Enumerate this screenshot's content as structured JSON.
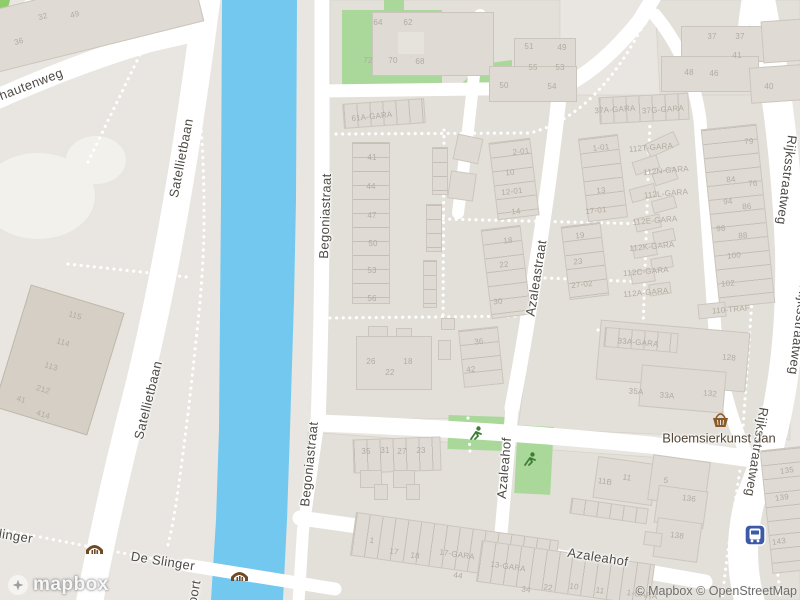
{
  "map": {
    "street_labels": [
      {
        "id": "hautenweg",
        "text": "hautenweg"
      },
      {
        "id": "satellietbaan-upper",
        "text": "Satellietbaan"
      },
      {
        "id": "satellietbaan-lower",
        "text": "Satellietbaan"
      },
      {
        "id": "begoniastraat-upper",
        "text": "Begoniastraat"
      },
      {
        "id": "begoniastraat-lower",
        "text": "Begoniastraat"
      },
      {
        "id": "azaleastraat",
        "text": "Azaleastraat"
      },
      {
        "id": "azaleahof-vertical",
        "text": "Azaleahof"
      },
      {
        "id": "azaleahof-bottom",
        "text": "Azaleahof"
      },
      {
        "id": "rijksstraatweg-upper",
        "text": "Rijksstraatweg"
      },
      {
        "id": "rijksstraatweg-middle",
        "text": "Rijksstraatweg"
      },
      {
        "id": "rijksstraatweg-lower",
        "text": "Rijksstraatweg"
      },
      {
        "id": "de-slinger",
        "text": "De Slinger"
      },
      {
        "id": "slinger-partial",
        "text": "linger"
      },
      {
        "id": "oort-partial",
        "text": "oort"
      }
    ],
    "poi": {
      "name": "Bloemsierkunst Jan",
      "icon": "basket-icon"
    },
    "icons": [
      "bridge-icon",
      "bridge-icon",
      "playground-icon",
      "playground-icon",
      "bus-stop-icon",
      "basket-icon"
    ],
    "colors": {
      "water": "#73c8ef",
      "green": "#a9d89a",
      "hedge": "#8fcd6a",
      "road": "#ffffff",
      "land": "#e9e6e1",
      "building": "#dfdbd4",
      "bus_blue": "#3d5aa8",
      "bridge_brown": "#6e4a26",
      "play_green": "#3f7d35",
      "basket_brown": "#8a5a2b"
    },
    "building_labels": [
      {
        "t": "32",
        "x": 43,
        "y": 17,
        "r": -15
      },
      {
        "t": "49",
        "x": 75,
        "y": 15,
        "r": -15
      },
      {
        "t": "36",
        "x": 19,
        "y": 42,
        "r": -15
      },
      {
        "t": "64",
        "x": 378,
        "y": 23,
        "r": 0
      },
      {
        "t": "62",
        "x": 408,
        "y": 23,
        "r": 0
      },
      {
        "t": "72",
        "x": 368,
        "y": 61,
        "r": 0
      },
      {
        "t": "70",
        "x": 393,
        "y": 61,
        "r": 0
      },
      {
        "t": "68",
        "x": 420,
        "y": 62,
        "r": 0
      },
      {
        "t": "51",
        "x": 529,
        "y": 47,
        "r": 0
      },
      {
        "t": "49",
        "x": 562,
        "y": 48,
        "r": 0
      },
      {
        "t": "55",
        "x": 533,
        "y": 68,
        "r": 0
      },
      {
        "t": "53",
        "x": 560,
        "y": 68,
        "r": 0
      },
      {
        "t": "50",
        "x": 504,
        "y": 86,
        "r": 0
      },
      {
        "t": "54",
        "x": 552,
        "y": 87,
        "r": 0
      },
      {
        "t": "37",
        "x": 712,
        "y": 37,
        "r": 0
      },
      {
        "t": "37",
        "x": 740,
        "y": 37,
        "r": 0
      },
      {
        "t": "41",
        "x": 737,
        "y": 56,
        "r": 0
      },
      {
        "t": "48",
        "x": 689,
        "y": 73,
        "r": 0
      },
      {
        "t": "46",
        "x": 714,
        "y": 74,
        "r": 0
      },
      {
        "t": "40",
        "x": 769,
        "y": 87,
        "r": 0
      },
      {
        "t": "61A-GARA",
        "x": 372,
        "y": 117,
        "r": -6
      },
      {
        "t": "37A-GARA",
        "x": 615,
        "y": 110,
        "r": -4
      },
      {
        "t": "37G-GARA",
        "x": 663,
        "y": 110,
        "r": -4
      },
      {
        "t": "41",
        "x": 372,
        "y": 158,
        "r": 0
      },
      {
        "t": "44",
        "x": 371,
        "y": 187,
        "r": 0
      },
      {
        "t": "47",
        "x": 372,
        "y": 216,
        "r": 0
      },
      {
        "t": "50",
        "x": 373,
        "y": 244,
        "r": 0
      },
      {
        "t": "53",
        "x": 372,
        "y": 271,
        "r": 0
      },
      {
        "t": "56",
        "x": 372,
        "y": 299,
        "r": 0
      },
      {
        "t": "2-01",
        "x": 521,
        "y": 152,
        "r": -6
      },
      {
        "t": "10",
        "x": 510,
        "y": 173,
        "r": -6
      },
      {
        "t": "12-01",
        "x": 512,
        "y": 192,
        "r": -6
      },
      {
        "t": "14",
        "x": 516,
        "y": 212,
        "r": -6
      },
      {
        "t": "18",
        "x": 508,
        "y": 241,
        "r": -6
      },
      {
        "t": "22",
        "x": 504,
        "y": 265,
        "r": -6
      },
      {
        "t": "30",
        "x": 498,
        "y": 302,
        "r": -6
      },
      {
        "t": "1-01",
        "x": 601,
        "y": 148,
        "r": -6
      },
      {
        "t": "13",
        "x": 601,
        "y": 191,
        "r": -6
      },
      {
        "t": "17-01",
        "x": 596,
        "y": 211,
        "r": -6
      },
      {
        "t": "19",
        "x": 580,
        "y": 236,
        "r": -6
      },
      {
        "t": "23",
        "x": 578,
        "y": 262,
        "r": -6
      },
      {
        "t": "27-02",
        "x": 582,
        "y": 285,
        "r": -6
      },
      {
        "t": "112T-GARA",
        "x": 651,
        "y": 148,
        "r": -5
      },
      {
        "t": "112N-GARA",
        "x": 666,
        "y": 171,
        "r": -5
      },
      {
        "t": "112L-GARA",
        "x": 666,
        "y": 194,
        "r": -5
      },
      {
        "t": "112E-GARA",
        "x": 655,
        "y": 221,
        "r": -5
      },
      {
        "t": "112K-GARA",
        "x": 652,
        "y": 247,
        "r": -5
      },
      {
        "t": "112C-GARA",
        "x": 646,
        "y": 272,
        "r": -5
      },
      {
        "t": "112A-GARA",
        "x": 646,
        "y": 293,
        "r": -5
      },
      {
        "t": "110-TRAF",
        "x": 731,
        "y": 310,
        "r": -5
      },
      {
        "t": "79",
        "x": 749,
        "y": 142,
        "r": -5
      },
      {
        "t": "84",
        "x": 731,
        "y": 180,
        "r": -5
      },
      {
        "t": "76",
        "x": 753,
        "y": 184,
        "r": -5
      },
      {
        "t": "94",
        "x": 728,
        "y": 202,
        "r": -5
      },
      {
        "t": "86",
        "x": 747,
        "y": 207,
        "r": -5
      },
      {
        "t": "98",
        "x": 721,
        "y": 229,
        "r": -5
      },
      {
        "t": "88",
        "x": 743,
        "y": 236,
        "r": -5
      },
      {
        "t": "100",
        "x": 734,
        "y": 256,
        "r": -5
      },
      {
        "t": "102",
        "x": 728,
        "y": 284,
        "r": -5
      },
      {
        "t": "33A-GARA",
        "x": 638,
        "y": 343,
        "r": 5
      },
      {
        "t": "128",
        "x": 729,
        "y": 358,
        "r": 5
      },
      {
        "t": "35A",
        "x": 636,
        "y": 392,
        "r": 5
      },
      {
        "t": "33A",
        "x": 667,
        "y": 396,
        "r": 5
      },
      {
        "t": "132",
        "x": 710,
        "y": 394,
        "r": 5
      },
      {
        "t": "26",
        "x": 371,
        "y": 362,
        "r": 0
      },
      {
        "t": "22",
        "x": 390,
        "y": 373,
        "r": 0
      },
      {
        "t": "18",
        "x": 408,
        "y": 362,
        "r": 0
      },
      {
        "t": "36",
        "x": 479,
        "y": 342,
        "r": -5
      },
      {
        "t": "42",
        "x": 471,
        "y": 370,
        "r": -5
      },
      {
        "t": "35",
        "x": 366,
        "y": 452,
        "r": 0
      },
      {
        "t": "31",
        "x": 385,
        "y": 451,
        "r": 0
      },
      {
        "t": "27",
        "x": 402,
        "y": 452,
        "r": 0
      },
      {
        "t": "23",
        "x": 421,
        "y": 451,
        "r": 0
      },
      {
        "t": "115",
        "x": 75,
        "y": 316,
        "r": 17
      },
      {
        "t": "114",
        "x": 63,
        "y": 343,
        "r": 17
      },
      {
        "t": "113",
        "x": 51,
        "y": 367,
        "r": 17
      },
      {
        "t": "212",
        "x": 43,
        "y": 390,
        "r": 17
      },
      {
        "t": "41",
        "x": 21,
        "y": 400,
        "r": 17
      },
      {
        "t": "414",
        "x": 43,
        "y": 415,
        "r": 17
      },
      {
        "t": "1",
        "x": 372,
        "y": 541,
        "r": 8
      },
      {
        "t": "17",
        "x": 394,
        "y": 552,
        "r": 8
      },
      {
        "t": "18",
        "x": 415,
        "y": 556,
        "r": 8
      },
      {
        "t": "17-GARA",
        "x": 457,
        "y": 555,
        "r": 8
      },
      {
        "t": "44",
        "x": 458,
        "y": 576,
        "r": 8
      },
      {
        "t": "13-GARA",
        "x": 508,
        "y": 567,
        "r": 8
      },
      {
        "t": "34",
        "x": 526,
        "y": 590,
        "r": 8
      },
      {
        "t": "22",
        "x": 548,
        "y": 588,
        "r": 8
      },
      {
        "t": "10",
        "x": 574,
        "y": 587,
        "r": 8
      },
      {
        "t": "11",
        "x": 600,
        "y": 591,
        "r": 8
      },
      {
        "t": "1-GARA",
        "x": 642,
        "y": 595,
        "r": 8
      },
      {
        "t": "11B",
        "x": 605,
        "y": 482,
        "r": 8
      },
      {
        "t": "11",
        "x": 627,
        "y": 478,
        "r": 8
      },
      {
        "t": "5",
        "x": 666,
        "y": 481,
        "r": 8
      },
      {
        "t": "136",
        "x": 689,
        "y": 499,
        "r": 8
      },
      {
        "t": "138",
        "x": 677,
        "y": 536,
        "r": 8
      },
      {
        "t": "135",
        "x": 787,
        "y": 471,
        "r": -8
      },
      {
        "t": "139",
        "x": 782,
        "y": 498,
        "r": -8
      },
      {
        "t": "143",
        "x": 779,
        "y": 542,
        "r": -8
      }
    ],
    "logo_text": "mapbox",
    "attribution": "© Mapbox © OpenStreetMap"
  }
}
